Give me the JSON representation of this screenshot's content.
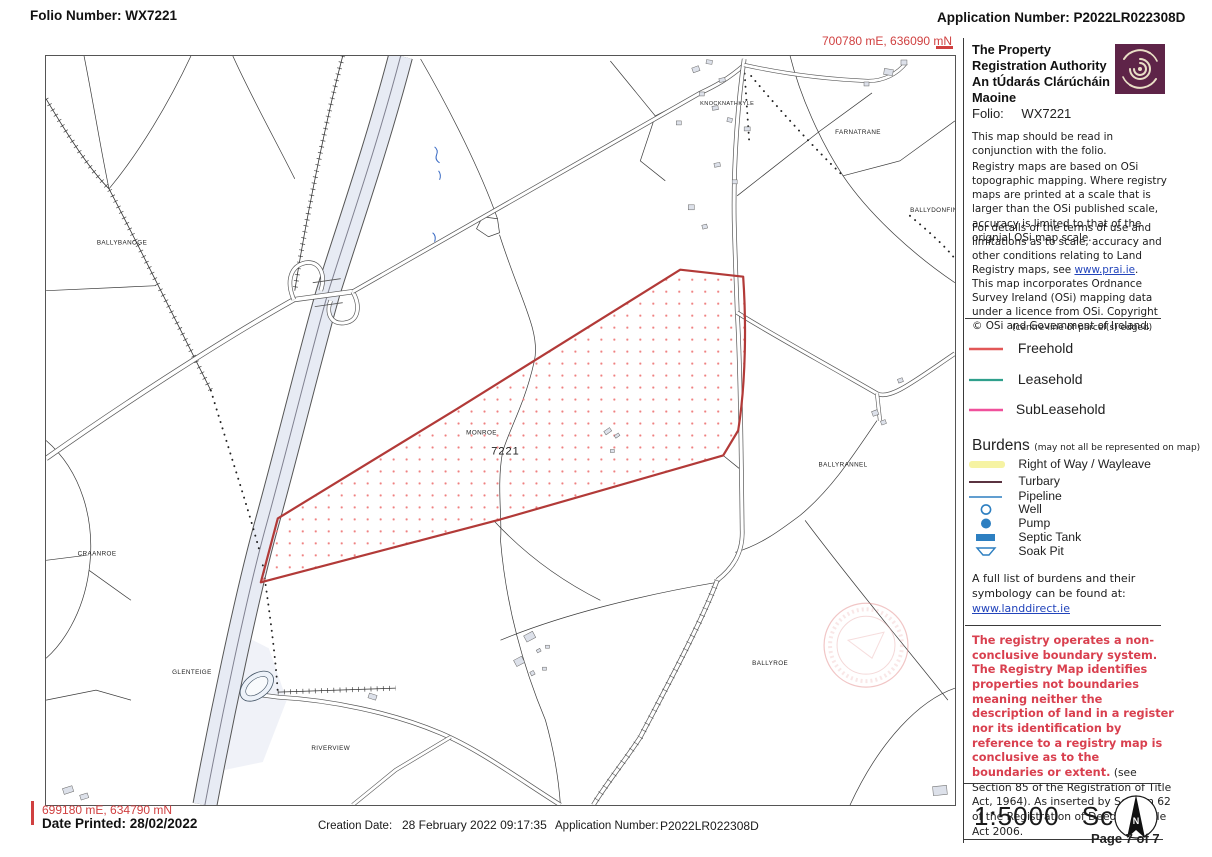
{
  "header": {
    "folio_label": "Folio Number: WX7221",
    "application_label": "Application Number: P2022LR022308D",
    "coord_top_right": "700780 mE, 636090 mN",
    "coord_bottom_left": "699180 mE, 634790 mN"
  },
  "sidebar": {
    "authority_en": "The Property Registration Authority",
    "authority_ga": "An tÚdarás Clárúcháin Maoine",
    "folio_label": "Folio:",
    "folio_value": "WX7221",
    "note_conjunction": "This map should be read in conjunction with the folio.",
    "para_osi": "Registry maps are based on OSi topographic mapping. Where registry maps are printed at a scale that is larger than the OSi published scale, accuracy is limited to that of the orignial OSi map scale.",
    "para_terms_prefix": "For details of the terms of use and limitations as to scale, accuracy and other conditions relating to Land Registry maps, see ",
    "para_terms_link": "www.prai.ie",
    "para_terms_suffix": ".",
    "para_copyright": "This map incorporates Ordnance Survey Ireland (OSi) mapping data under a licence from OSi. Copyright © OSi and Government of Ireland.",
    "legend_note": "(centre-line of parcel(s) edged)",
    "legend": [
      {
        "label": "Freehold",
        "color": "#e25757"
      },
      {
        "label": "Leasehold",
        "color": "#2fa08c"
      },
      {
        "label": "SubLeasehold",
        "color": "#f0509b"
      }
    ],
    "burdens_title": "Burdens",
    "burdens_note": "(may not all be represented on map)",
    "burdens": [
      {
        "symbol": "right-of-way-band",
        "label": "Right of Way / Wayleave"
      },
      {
        "symbol": "turbary-line",
        "label": "Turbary"
      },
      {
        "symbol": "pipeline-line",
        "label": "Pipeline"
      },
      {
        "symbol": "well-circle",
        "label": "Well"
      },
      {
        "symbol": "pump-dot",
        "label": "Pump"
      },
      {
        "symbol": "septic-tank-rect",
        "label": "Septic Tank"
      },
      {
        "symbol": "soak-pit-trapezoid",
        "label": "Soak Pit"
      }
    ],
    "burden_list_text": "A full list of burdens and their symbology can be found at:",
    "burden_list_link": "www.landdirect.ie",
    "warning_red": "The registry operates a non-conclusive boundary system. The Registry Map identifies properties not boundaries meaning neither the description of land in a register nor its identification by reference to a registry map is conclusive as to the boundaries or extent.",
    "warning_black": " (see Section 85 of the Registration of Title Act, 1964). As inserted by Section 62 of the Registration of Deed and Title Act 2006.",
    "scale_value": "1:5000",
    "scale_label": "Scale",
    "page_label": "Page 7 of 7",
    "compass_n": "N"
  },
  "footer": {
    "date_printed": "Date Printed: 28/02/2022",
    "creation_date_label": "Creation Date:",
    "creation_date_value": "28 February 2022 09:17:35",
    "application_label": "Application Number:",
    "application_value": "P2022LR022308D"
  },
  "map": {
    "parcel_number": "7221",
    "labels": {
      "ballybanoge": "BALLYBANOGE",
      "knocknathkyle": "KNOCKNATHKYLE",
      "farnatrane": "FARNATRANE",
      "ballydonfin": "BALLYDONFIN",
      "monroe": "MONROE",
      "ballyrannel": "BALLYRANNEL",
      "craanroe": "CRAANROE",
      "glenteige": "GLENTEIGE",
      "ballyroe": "BALLYROE",
      "riverview": "RIVERVIEW"
    }
  },
  "colors": {
    "freehold_red": "#e25757",
    "leasehold_teal": "#2fa08c",
    "subleasehold_pink": "#f0509b",
    "right_of_way_yellow": "#f6f3a3",
    "turbary_maroon": "#5a3340",
    "burden_blue": "#2d7fc1",
    "link_blue": "#2244bb",
    "warning_red": "#d9404f",
    "coordinate_red": "#d04040",
    "parcel_red": "#b23a38",
    "logo_maroon": "#5e2448"
  }
}
